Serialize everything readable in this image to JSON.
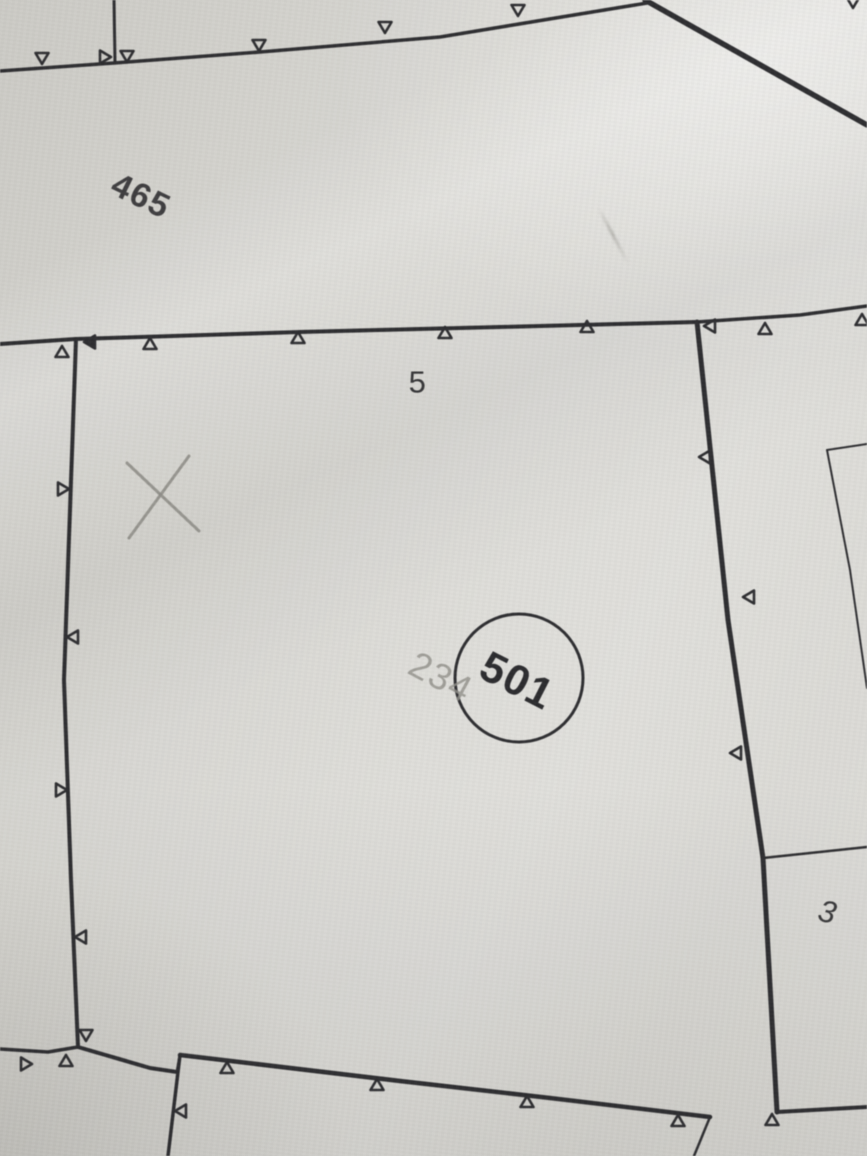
{
  "photo": {
    "description": "photograph of cadastral parcel map"
  },
  "map": {
    "ink": "#2e2e31",
    "pencil": "#8f8e88",
    "labels": [
      {
        "id": "parcel-465",
        "text": "465",
        "x": 141,
        "y": 196,
        "rotate": 26,
        "size": 34,
        "weight": "bold",
        "color": "#3f3e40"
      },
      {
        "id": "parcel-5",
        "text": "5",
        "x": 418,
        "y": 382,
        "rotate": 0,
        "size": 31,
        "weight": "normal",
        "color": "#353537"
      },
      {
        "id": "parcel-501",
        "text": "501",
        "x": 517,
        "y": 681,
        "rotate": 27,
        "size": 43,
        "weight": "bold",
        "color": "#2c2c2f"
      },
      {
        "id": "pencil-234",
        "text": "234",
        "x": 441,
        "y": 677,
        "rotate": 28,
        "size": 37,
        "weight": "normal",
        "color": "#91908a",
        "opacity": 0.8
      },
      {
        "id": "parcel-3",
        "text": "3",
        "x": 828,
        "y": 912,
        "rotate": 14,
        "size": 31,
        "weight": "normal",
        "color": "#39393b",
        "italic": true
      }
    ],
    "circle": {
      "cx": 519,
      "cy": 678,
      "r": 64,
      "width": 3
    },
    "cross": {
      "color": "#8c8b85",
      "width": 3,
      "strokes": [
        [
          127,
          463,
          199,
          531
        ],
        [
          189,
          456,
          129,
          538
        ]
      ]
    },
    "lines": [
      {
        "name": "top-left-vertical",
        "w": 3.0,
        "pts": [
          [
            114,
            0
          ],
          [
            115,
            63
          ]
        ]
      },
      {
        "name": "top-fence",
        "w": 3.5,
        "pts": [
          [
            0,
            71
          ],
          [
            114,
            63
          ],
          [
            260,
            52
          ],
          [
            440,
            37
          ],
          [
            647,
            3
          ]
        ]
      },
      {
        "name": "top-diagonal",
        "w": 5.5,
        "pts": [
          [
            645,
            0
          ],
          [
            867,
            125
          ]
        ]
      },
      {
        "name": "parcel5-top",
        "w": 4.0,
        "pts": [
          [
            0,
            344
          ],
          [
            76,
            339
          ],
          [
            300,
            332
          ],
          [
            500,
            327
          ],
          [
            697,
            322
          ]
        ]
      },
      {
        "name": "parcel5-top-east",
        "w": 3.5,
        "pts": [
          [
            697,
            322
          ],
          [
            800,
            315
          ],
          [
            867,
            306
          ]
        ]
      },
      {
        "name": "parcel5-left",
        "w": 4.0,
        "pts": [
          [
            76,
            339
          ],
          [
            64,
            680
          ],
          [
            71,
            880
          ],
          [
            78,
            1047
          ]
        ]
      },
      {
        "name": "west-line",
        "w": 3.5,
        "pts": [
          [
            0,
            1049
          ],
          [
            48,
            1052
          ],
          [
            78,
            1047
          ]
        ]
      },
      {
        "name": "parcel5-bottom-west",
        "w": 4.0,
        "pts": [
          [
            78,
            1047
          ],
          [
            150,
            1068
          ],
          [
            177,
            1072
          ]
        ]
      },
      {
        "name": "bottom-parcel-joint",
        "w": 3.0,
        "pts": [
          [
            177,
            1072
          ],
          [
            180,
            1055
          ]
        ]
      },
      {
        "name": "bottom-parcel-top",
        "w": 4.5,
        "pts": [
          [
            180,
            1055
          ],
          [
            400,
            1081
          ],
          [
            550,
            1098
          ],
          [
            710,
            1117
          ]
        ]
      },
      {
        "name": "bottom-parcel-left",
        "w": 3.5,
        "pts": [
          [
            180,
            1055
          ],
          [
            168,
            1156
          ]
        ]
      },
      {
        "name": "parcel5-right",
        "w": 5.0,
        "pts": [
          [
            697,
            322
          ],
          [
            728,
            620
          ],
          [
            763,
            858
          ],
          [
            777,
            1112
          ]
        ]
      },
      {
        "name": "bottom-east",
        "w": 4.0,
        "pts": [
          [
            777,
            1112
          ],
          [
            867,
            1107
          ]
        ]
      },
      {
        "name": "thin-branch-south",
        "w": 2.5,
        "pts": [
          [
            710,
            1117
          ],
          [
            694,
            1156
          ]
        ]
      },
      {
        "name": "thin-line-east",
        "w": 2.5,
        "pts": [
          [
            763,
            858
          ],
          [
            867,
            847
          ]
        ]
      },
      {
        "name": "thin-rect-top",
        "w": 2.0,
        "pts": [
          [
            827,
            450
          ],
          [
            867,
            444
          ]
        ]
      },
      {
        "name": "thin-rect-left",
        "w": 2.0,
        "pts": [
          [
            827,
            450
          ],
          [
            850,
            570
          ],
          [
            867,
            688
          ]
        ]
      }
    ],
    "markers": [
      {
        "x": 42,
        "y": 64,
        "dir": "down"
      },
      {
        "x": 127,
        "y": 62,
        "dir": "down"
      },
      {
        "x": 259,
        "y": 51,
        "dir": "down"
      },
      {
        "x": 385,
        "y": 33,
        "dir": "down"
      },
      {
        "x": 518,
        "y": 16,
        "dir": "down"
      },
      {
        "x": 853,
        "y": 8,
        "dir": "down"
      },
      {
        "x": 111,
        "y": 57,
        "dir": "right"
      },
      {
        "x": 62,
        "y": 346,
        "dir": "up"
      },
      {
        "x": 150,
        "y": 338,
        "dir": "up"
      },
      {
        "x": 298,
        "y": 332,
        "dir": "up"
      },
      {
        "x": 445,
        "y": 327,
        "dir": "up"
      },
      {
        "x": 587,
        "y": 321,
        "dir": "up"
      },
      {
        "x": 765,
        "y": 323,
        "dir": "up"
      },
      {
        "x": 862,
        "y": 314,
        "dir": "up"
      },
      {
        "x": 84,
        "y": 342,
        "dir": "left",
        "fill": true
      },
      {
        "x": 704,
        "y": 326,
        "dir": "left"
      },
      {
        "x": 69,
        "y": 489,
        "dir": "right"
      },
      {
        "x": 67,
        "y": 637,
        "dir": "left"
      },
      {
        "x": 67,
        "y": 790,
        "dir": "right"
      },
      {
        "x": 75,
        "y": 937,
        "dir": "left"
      },
      {
        "x": 699,
        "y": 457,
        "dir": "left"
      },
      {
        "x": 743,
        "y": 597,
        "dir": "left"
      },
      {
        "x": 730,
        "y": 753,
        "dir": "left"
      },
      {
        "x": 227,
        "y": 1062,
        "dir": "up"
      },
      {
        "x": 377,
        "y": 1079,
        "dir": "up"
      },
      {
        "x": 527,
        "y": 1096,
        "dir": "up"
      },
      {
        "x": 678,
        "y": 1115,
        "dir": "up"
      },
      {
        "x": 772,
        "y": 1114,
        "dir": "up"
      },
      {
        "x": 175,
        "y": 1111,
        "dir": "left"
      },
      {
        "x": 86,
        "y": 1041,
        "dir": "down"
      },
      {
        "x": 66,
        "y": 1055,
        "dir": "up"
      },
      {
        "x": 32,
        "y": 1064,
        "dir": "right"
      }
    ]
  }
}
